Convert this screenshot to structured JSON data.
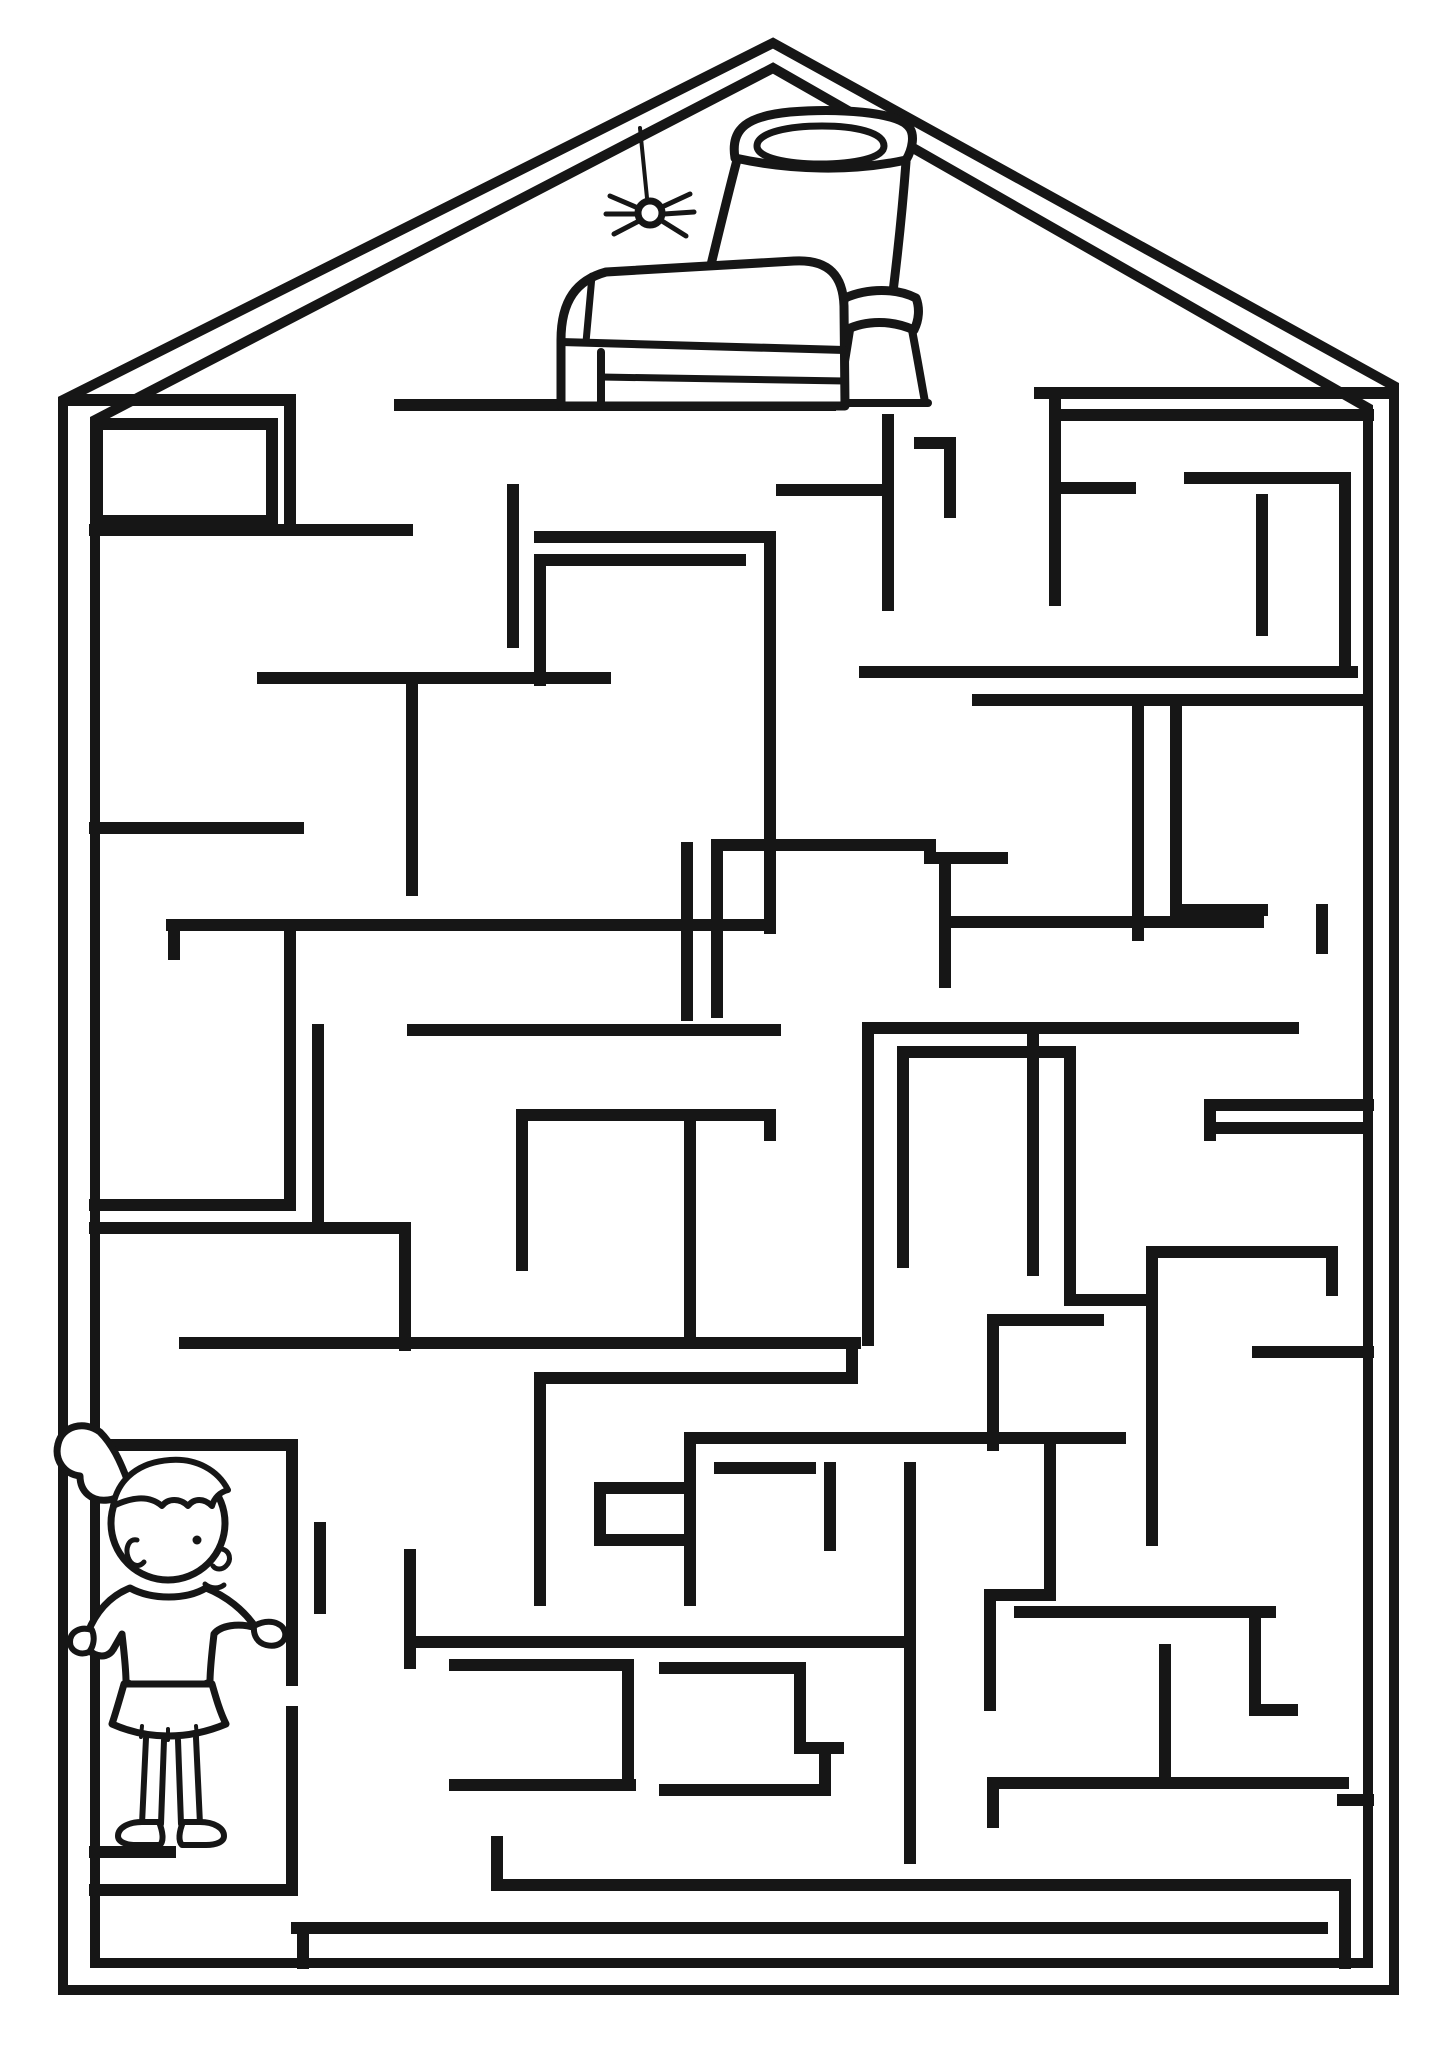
{
  "canvas": {
    "w": 1448,
    "h": 2048
  },
  "colors": {
    "paper": "#ffffff",
    "ink": "#161616"
  },
  "outline": {
    "stroke": 10,
    "outer": [
      [
        63,
        1990
      ],
      [
        63,
        400
      ],
      [
        773,
        43
      ],
      [
        1394,
        386
      ],
      [
        1394,
        1990
      ]
    ],
    "inner": [
      [
        95,
        1963
      ],
      [
        95,
        420
      ],
      [
        773,
        68
      ],
      [
        1368,
        408
      ],
      [
        1368,
        1963
      ]
    ]
  },
  "walls": {
    "stroke": 12,
    "segments": [
      [
        400,
        405,
        830,
        405
      ],
      [
        888,
        420,
        888,
        605
      ],
      [
        782,
        490,
        888,
        490
      ],
      [
        70,
        400,
        290,
        400
      ],
      [
        290,
        400,
        290,
        530
      ],
      [
        95,
        530,
        407,
        530
      ],
      [
        97,
        424,
        272,
        424
      ],
      [
        272,
        424,
        272,
        521
      ],
      [
        97,
        424,
        97,
        521
      ],
      [
        97,
        521,
        272,
        521
      ],
      [
        1040,
        393,
        1385,
        393
      ],
      [
        1065,
        415,
        1368,
        415
      ],
      [
        1055,
        393,
        1055,
        600
      ],
      [
        1055,
        488,
        1130,
        488
      ],
      [
        1190,
        478,
        1345,
        478
      ],
      [
        1345,
        478,
        1345,
        670
      ],
      [
        1262,
        500,
        1262,
        630
      ],
      [
        865,
        672,
        1352,
        672
      ],
      [
        920,
        443,
        950,
        443
      ],
      [
        950,
        445,
        950,
        512
      ],
      [
        513,
        490,
        513,
        642
      ],
      [
        540,
        537,
        768,
        537
      ],
      [
        540,
        560,
        740,
        560
      ],
      [
        540,
        560,
        540,
        680
      ],
      [
        770,
        537,
        770,
        928
      ],
      [
        263,
        678,
        605,
        678
      ],
      [
        412,
        678,
        412,
        890
      ],
      [
        95,
        828,
        298,
        828
      ],
      [
        172,
        925,
        770,
        925
      ],
      [
        174,
        925,
        174,
        954
      ],
      [
        290,
        925,
        290,
        1205
      ],
      [
        318,
        1030,
        318,
        1228
      ],
      [
        687,
        848,
        687,
        1015
      ],
      [
        717,
        845,
        717,
        1012
      ],
      [
        717,
        845,
        930,
        845
      ],
      [
        930,
        845,
        930,
        858
      ],
      [
        930,
        858,
        1002,
        858
      ],
      [
        413,
        1030,
        775,
        1030
      ],
      [
        868,
        1028,
        1293,
        1028
      ],
      [
        868,
        1028,
        868,
        1340
      ],
      [
        1033,
        1028,
        1033,
        1270
      ],
      [
        903,
        1052,
        1070,
        1052
      ],
      [
        903,
        1052,
        903,
        1262
      ],
      [
        1070,
        1052,
        1070,
        1300
      ],
      [
        1070,
        1300,
        1152,
        1300
      ],
      [
        1152,
        1252,
        1332,
        1252
      ],
      [
        1332,
        1252,
        1332,
        1290
      ],
      [
        1152,
        1252,
        1152,
        1540
      ],
      [
        945,
        922,
        1258,
        922
      ],
      [
        945,
        858,
        945,
        982
      ],
      [
        978,
        700,
        1362,
        700
      ],
      [
        1138,
        700,
        1138,
        935
      ],
      [
        1176,
        700,
        1176,
        912
      ],
      [
        1176,
        910,
        1262,
        910
      ],
      [
        1322,
        910,
        1322,
        948
      ],
      [
        1210,
        1105,
        1368,
        1105
      ],
      [
        1210,
        1128,
        1360,
        1128
      ],
      [
        1210,
        1105,
        1210,
        1135
      ],
      [
        95,
        1205,
        285,
        1205
      ],
      [
        95,
        1228,
        405,
        1228
      ],
      [
        405,
        1228,
        405,
        1345
      ],
      [
        185,
        1343,
        855,
        1343
      ],
      [
        852,
        1343,
        852,
        1378
      ],
      [
        545,
        1378,
        852,
        1378
      ],
      [
        540,
        1378,
        540,
        1600
      ],
      [
        690,
        1115,
        690,
        1343
      ],
      [
        522,
        1115,
        770,
        1115
      ],
      [
        522,
        1115,
        522,
        1265
      ],
      [
        770,
        1115,
        770,
        1135
      ],
      [
        95,
        1445,
        292,
        1445
      ],
      [
        292,
        1445,
        292,
        1680
      ],
      [
        292,
        1712,
        292,
        1888
      ],
      [
        95,
        1852,
        170,
        1852
      ],
      [
        95,
        1890,
        292,
        1890
      ],
      [
        320,
        1528,
        320,
        1608
      ],
      [
        410,
        1555,
        410,
        1663
      ],
      [
        410,
        1642,
        910,
        1642
      ],
      [
        690,
        1438,
        1120,
        1438
      ],
      [
        690,
        1438,
        690,
        1600
      ],
      [
        600,
        1488,
        690,
        1488
      ],
      [
        600,
        1488,
        600,
        1540
      ],
      [
        600,
        1540,
        690,
        1540
      ],
      [
        720,
        1468,
        810,
        1468
      ],
      [
        830,
        1468,
        830,
        1545
      ],
      [
        910,
        1468,
        910,
        1858
      ],
      [
        455,
        1665,
        628,
        1665
      ],
      [
        628,
        1665,
        628,
        1782
      ],
      [
        455,
        1785,
        630,
        1785
      ],
      [
        665,
        1668,
        800,
        1668
      ],
      [
        800,
        1668,
        800,
        1748
      ],
      [
        800,
        1748,
        838,
        1748
      ],
      [
        825,
        1748,
        825,
        1790
      ],
      [
        665,
        1790,
        825,
        1790
      ],
      [
        497,
        1885,
        1345,
        1885
      ],
      [
        497,
        1842,
        497,
        1885
      ],
      [
        1345,
        1885,
        1345,
        1963
      ],
      [
        297,
        1928,
        1322,
        1928
      ],
      [
        303,
        1928,
        303,
        1963
      ],
      [
        993,
        1320,
        1098,
        1320
      ],
      [
        993,
        1320,
        993,
        1445
      ],
      [
        1050,
        1445,
        1050,
        1595
      ],
      [
        990,
        1595,
        1050,
        1595
      ],
      [
        990,
        1595,
        990,
        1705
      ],
      [
        1020,
        1612,
        1270,
        1612
      ],
      [
        1255,
        1612,
        1255,
        1710
      ],
      [
        1255,
        1710,
        1292,
        1710
      ],
      [
        1165,
        1650,
        1165,
        1783
      ],
      [
        993,
        1783,
        1343,
        1783
      ],
      [
        993,
        1783,
        993,
        1822
      ],
      [
        1343,
        1800,
        1368,
        1800
      ],
      [
        1258,
        1352,
        1368,
        1352
      ]
    ]
  },
  "figure_stroke": 8,
  "scene": [
    {
      "name": "pot",
      "prims": [
        {
          "t": "path",
          "n": "pot-rim-outer",
          "f": "white",
          "sw": 9,
          "d": "M735,158 C730,128 748,116 790,112 C838,108 896,112 908,126 C916,134 912,150 906,160 C852,172 790,170 735,158 Z"
        },
        {
          "t": "path",
          "n": "pot-rim-inner",
          "f": "none",
          "sw": 7,
          "d": "M757,146 C757,132 790,126 822,126 C854,126 884,132 884,146 C884,158 854,164 820,164 C788,164 757,158 757,146 Z"
        },
        {
          "t": "path",
          "n": "pot-left-side",
          "f": "none",
          "sw": 9,
          "d": "M737,160 C716,240 696,330 678,402"
        },
        {
          "t": "path",
          "n": "pot-right-side",
          "f": "none",
          "sw": 9,
          "d": "M906,162 C902,215 897,260 892,300"
        },
        {
          "t": "path",
          "n": "pot-collar-ring",
          "f": "white",
          "sw": 9,
          "d": "M845,298 C868,288 896,288 916,298 C920,308 919,320 914,330 C892,320 866,320 846,330 C841,320 841,308 845,298 Z"
        },
        {
          "t": "path",
          "n": "pot-neck-left",
          "f": "none",
          "sw": 8,
          "d": "M850,330 C846,356 842,380 838,402"
        },
        {
          "t": "path",
          "n": "pot-neck-right",
          "f": "none",
          "sw": 8,
          "d": "M912,330 C917,356 921,380 925,402"
        },
        {
          "t": "path",
          "n": "pot-base",
          "f": "none",
          "sw": 8,
          "d": "M836,403 L928,403"
        }
      ]
    },
    {
      "name": "treasure-chest",
      "prims": [
        {
          "t": "path",
          "n": "chest-body",
          "f": "white",
          "sw": 9,
          "d": "M561,406 L561,340 C561,300 577,280 606,272 L794,261 C830,259 843,277 844,306 L845,406 Z"
        },
        {
          "t": "path",
          "n": "chest-lid-seam",
          "f": "none",
          "sw": 8,
          "d": "M561,342 L844,350"
        },
        {
          "t": "path",
          "n": "chest-lid-facet",
          "f": "none",
          "sw": 7,
          "d": "M592,276 L586,342"
        },
        {
          "t": "path",
          "n": "chest-strap-vertical",
          "f": "none",
          "sw": 8,
          "d": "M601,352 L601,406"
        },
        {
          "t": "path",
          "n": "chest-front-band",
          "f": "none",
          "sw": 7,
          "d": "M601,377 L845,381"
        }
      ]
    },
    {
      "name": "spider",
      "prims": [
        {
          "t": "line",
          "n": "spider-thread",
          "sw": 4,
          "x1": 640,
          "y1": 128,
          "x2": 647,
          "y2": 198
        },
        {
          "t": "line",
          "n": "spider-leg",
          "sw": 5,
          "x1": 638,
          "y1": 208,
          "x2": 610,
          "y2": 196
        },
        {
          "t": "line",
          "n": "spider-leg",
          "sw": 5,
          "x1": 636,
          "y1": 214,
          "x2": 606,
          "y2": 214
        },
        {
          "t": "line",
          "n": "spider-leg",
          "sw": 5,
          "x1": 639,
          "y1": 221,
          "x2": 614,
          "y2": 234
        },
        {
          "t": "line",
          "n": "spider-leg",
          "sw": 5,
          "x1": 662,
          "y1": 207,
          "x2": 690,
          "y2": 194
        },
        {
          "t": "line",
          "n": "spider-leg",
          "sw": 5,
          "x1": 664,
          "y1": 214,
          "x2": 694,
          "y2": 212
        },
        {
          "t": "line",
          "n": "spider-leg",
          "sw": 5,
          "x1": 662,
          "y1": 221,
          "x2": 686,
          "y2": 236
        },
        {
          "t": "circle",
          "n": "spider-body",
          "f": "white",
          "sw": 7,
          "cx": 650,
          "cy": 213,
          "r": 12
        }
      ]
    },
    {
      "name": "girl-start",
      "prims": [
        {
          "t": "path",
          "n": "girl-ponytail",
          "f": "white",
          "sw": 7,
          "d": "M100,1432 C84,1420 62,1426 58,1444 C54,1460 64,1474 80,1476 C80,1492 92,1502 108,1500 C118,1499 126,1492 128,1482 C120,1460 112,1444 100,1432 Z"
        },
        {
          "t": "circle",
          "n": "girl-head",
          "f": "white",
          "sw": 7,
          "cx": 168,
          "cy": 1523,
          "r": 57
        },
        {
          "t": "path",
          "n": "girl-hair-fringe",
          "f": "white",
          "sw": 6,
          "d": "M113,1506 C118,1478 140,1462 170,1460 C196,1458 218,1470 228,1490 C220,1492 214,1498 212,1506 C204,1498 194,1498 188,1506 C180,1498 168,1498 162,1506 C148,1494 130,1498 113,1506 Z"
        },
        {
          "t": "circle",
          "n": "girl-eye",
          "f": "ink",
          "sw": 0,
          "cx": 197,
          "cy": 1540,
          "r": 4.5
        },
        {
          "t": "path",
          "n": "girl-nose",
          "f": "none",
          "sw": 5,
          "d": "M222,1549 C230,1551 232,1560 226,1566 C222,1570 216,1570 213,1566"
        },
        {
          "t": "path",
          "n": "girl-mouth",
          "f": "none",
          "sw": 5,
          "d": "M205,1584 C211,1589 219,1589 224,1585"
        },
        {
          "t": "path",
          "n": "girl-ear",
          "f": "none",
          "sw": 5,
          "d": "M137,1540 C129,1538 125,1548 128,1557 C131,1566 139,1568 144,1562"
        },
        {
          "t": "path",
          "n": "girl-shirt",
          "f": "white",
          "sw": 7,
          "d": "M130,1588 C152,1600 186,1600 206,1588 C226,1596 244,1610 256,1628 C238,1622 220,1626 214,1634 C212,1652 210,1668 210,1682 C180,1694 152,1694 126,1682 C126,1668 124,1652 122,1634 L114,1648 C110,1656 102,1658 94,1654 C86,1650 84,1642 88,1632 C96,1612 110,1596 130,1588 Z"
        },
        {
          "t": "path",
          "n": "girl-right-hand",
          "f": "white",
          "sw": 6,
          "d": "M254,1626 C268,1618 282,1622 285,1632 C287,1641 278,1648 266,1645 C258,1643 253,1636 254,1626 Z"
        },
        {
          "t": "path",
          "n": "girl-left-hand",
          "f": "white",
          "sw": 6,
          "d": "M92,1630 C80,1626 70,1632 70,1642 C70,1651 80,1656 89,1652 C94,1646 95,1637 92,1630 Z"
        },
        {
          "t": "path",
          "n": "girl-skirt",
          "f": "white",
          "sw": 7,
          "d": "M124,1684 L212,1684 C216,1698 220,1712 226,1724 C188,1740 148,1740 112,1724 C116,1712 120,1698 124,1684 Z"
        },
        {
          "t": "line",
          "n": "girl-skirt-pleat",
          "sw": 4,
          "x1": 142,
          "y1": 1726,
          "x2": 141,
          "y2": 1737
        },
        {
          "t": "line",
          "n": "girl-skirt-pleat",
          "sw": 4,
          "x1": 168,
          "y1": 1729,
          "x2": 168,
          "y2": 1740
        },
        {
          "t": "line",
          "n": "girl-skirt-pleat",
          "sw": 4,
          "x1": 196,
          "y1": 1726,
          "x2": 197,
          "y2": 1737
        },
        {
          "t": "line",
          "n": "girl-leg-outline",
          "sw": 6,
          "x1": 146,
          "y1": 1738,
          "x2": 142,
          "y2": 1824
        },
        {
          "t": "line",
          "n": "girl-leg-outline",
          "sw": 6,
          "x1": 164,
          "y1": 1740,
          "x2": 161,
          "y2": 1824
        },
        {
          "t": "line",
          "n": "girl-leg-outline",
          "sw": 6,
          "x1": 178,
          "y1": 1740,
          "x2": 181,
          "y2": 1824
        },
        {
          "t": "line",
          "n": "girl-leg-outline",
          "sw": 6,
          "x1": 196,
          "y1": 1738,
          "x2": 200,
          "y2": 1824
        },
        {
          "t": "path",
          "n": "girl-left-shoe",
          "f": "white",
          "sw": 6,
          "d": "M142,1822 C128,1822 118,1828 118,1836 C118,1842 126,1845 136,1845 L160,1845 C164,1841 163,1832 159,1822 Z"
        },
        {
          "t": "path",
          "n": "girl-right-shoe",
          "f": "white",
          "sw": 6,
          "d": "M183,1822 C179,1832 178,1841 182,1845 L206,1845 C216,1845 224,1842 224,1836 C224,1828 214,1822 200,1822 Z"
        }
      ]
    }
  ]
}
